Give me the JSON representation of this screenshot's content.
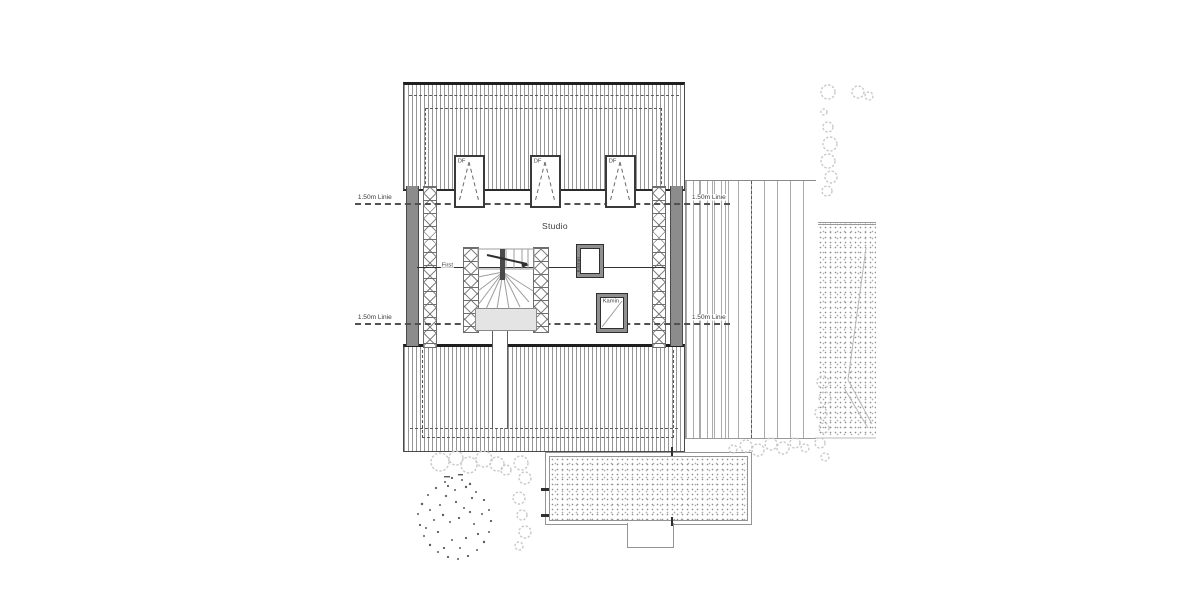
{
  "labels": {
    "height_lines": [
      "1.50m Linie",
      "1.50m Linie",
      "1.50m Linie",
      "1.50m Linie"
    ],
    "room": "Studio",
    "ridge": "First",
    "chimneys": [
      "Kamin",
      "Kamin"
    ],
    "roof_windows": [
      "DF",
      "DF",
      "DF"
    ]
  },
  "colors": {
    "background": "#ffffff",
    "ink": "#2f2f2f",
    "light_line": "#a0a0a0",
    "wall_fill": "#8c8c8c",
    "vegetation": "#c9c9c9",
    "landing_fill": "#e4e4e4"
  }
}
